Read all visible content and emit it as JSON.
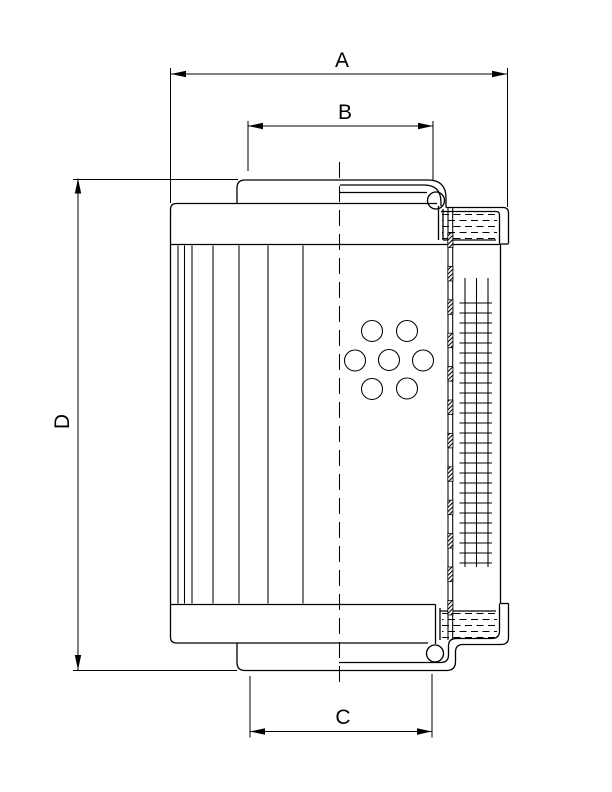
{
  "drawing": {
    "kind": "filter-element-dimensional-drawing",
    "ink_color": "#000000",
    "background_color": "#ffffff",
    "dims": {
      "A": "A",
      "B": "B",
      "C": "C",
      "D": "D"
    }
  }
}
